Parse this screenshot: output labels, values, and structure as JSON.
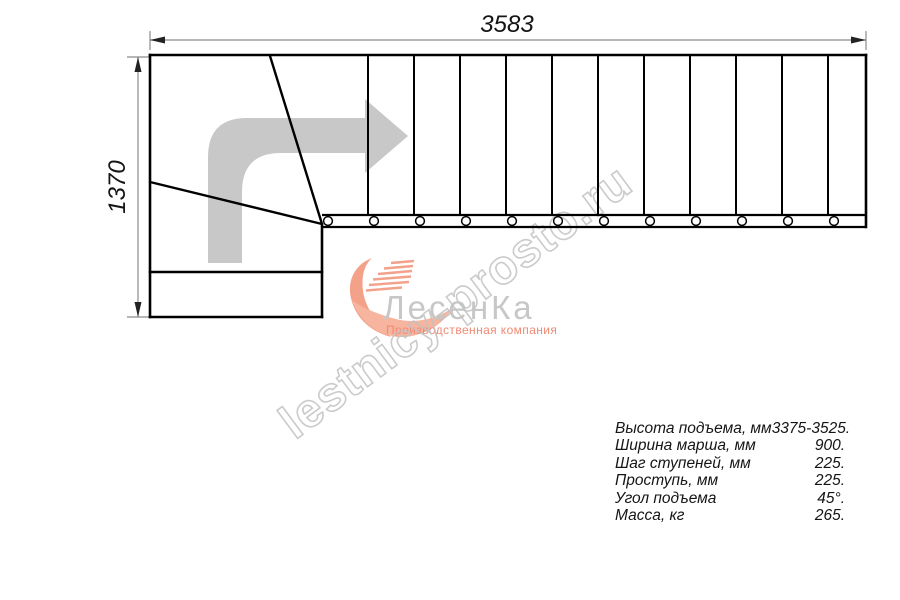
{
  "drawing": {
    "top_dimension": "3583",
    "left_dimension": "1370"
  },
  "watermark": {
    "text": "lestnicy-prosto.ru"
  },
  "logo": {
    "name": "ЛесенКа",
    "tagline": "Производственная компания"
  },
  "specs": {
    "rows": [
      {
        "label": "Высота подъема, мм",
        "value": "3375-3525."
      },
      {
        "label": "Ширина марша, мм",
        "value": "900."
      },
      {
        "label": "Шаг ступеней, мм",
        "value": "225."
      },
      {
        "label": "Проступь, мм",
        "value": "225."
      },
      {
        "label": "Угол подъема",
        "value": "45°."
      },
      {
        "label": "Масса, кг",
        "value": "265."
      }
    ]
  },
  "colors": {
    "plan_line": "#000000",
    "dimension_line": "#8c8c8c",
    "direction_arrow": "#c8c8c8",
    "watermark_outline": "#c2c2c2",
    "logo_gray": "#c7c7c7",
    "logo_salmon": "#f4a18a"
  },
  "icons": {
    "direction_arrow": "direction-arrow-icon",
    "logo_swoosh": "logo-swoosh-icon"
  }
}
